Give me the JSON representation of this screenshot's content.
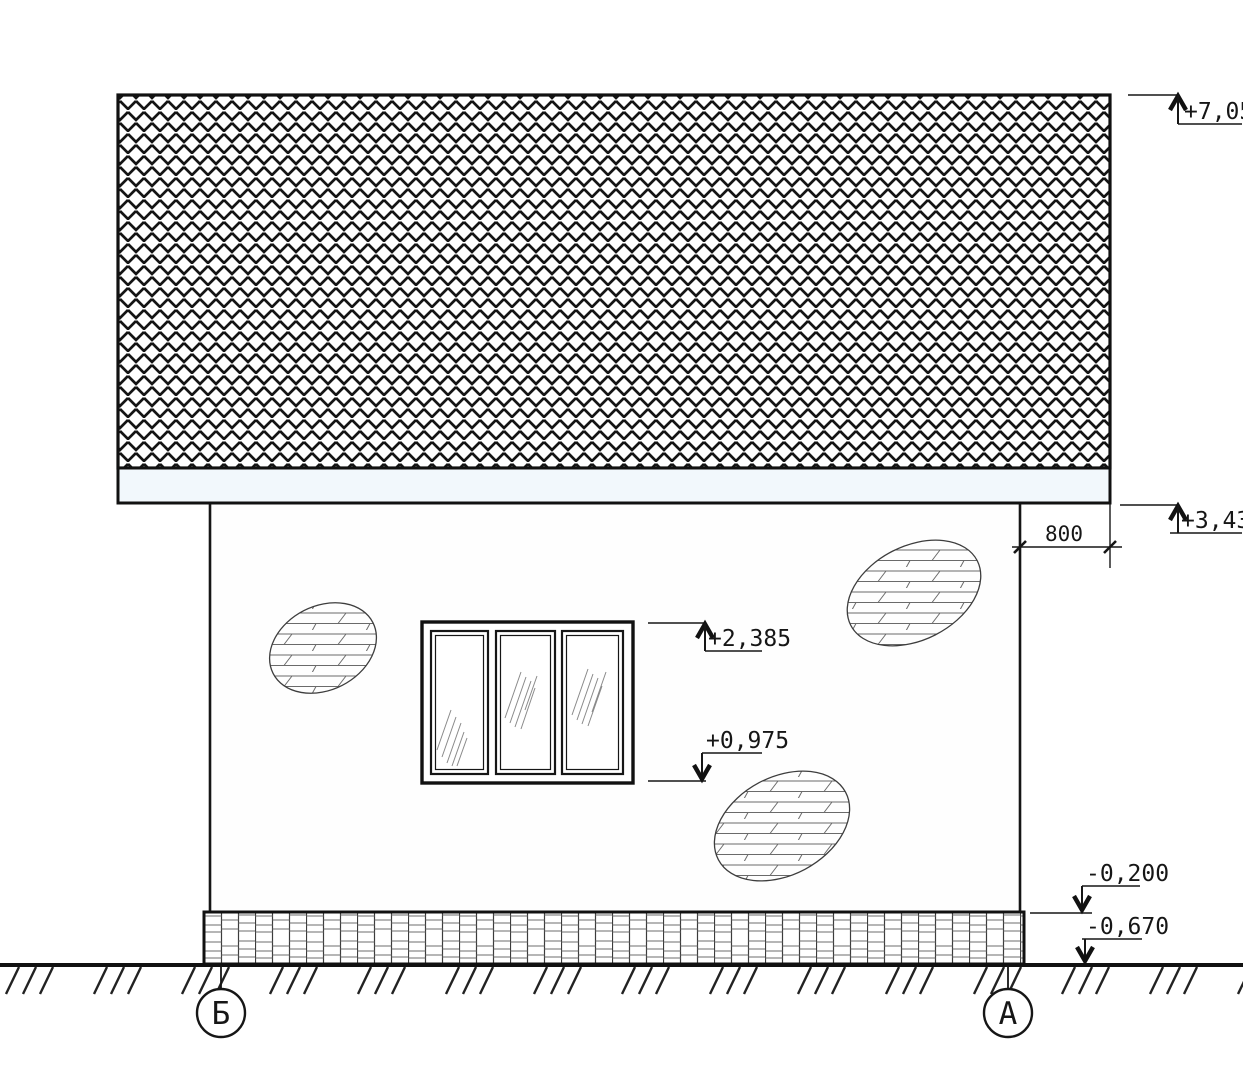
{
  "elevation_marks": {
    "ridge": "+7,058",
    "eaves": "+3,430",
    "window_head": "+2,385",
    "window_sill": "+0,975",
    "plinth_top": "-0,200",
    "ground": "-0,670"
  },
  "dimensions": {
    "eaves_overhang": "800"
  },
  "axes": {
    "left": "Б",
    "right": "А"
  },
  "colors": {
    "line": "#161616",
    "thin_hatch": "#6a6a6a",
    "fascia_fill": "#f2f8fc",
    "background": "#ffffff"
  }
}
